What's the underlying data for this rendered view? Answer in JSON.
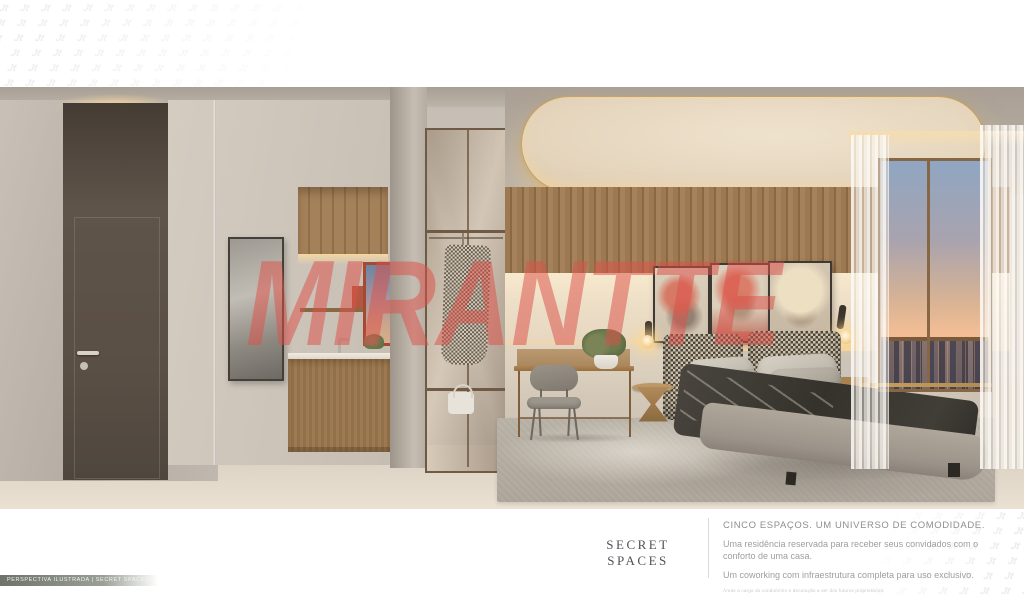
{
  "watermark": {
    "text": "MIRANTTE",
    "color": "#dd5048"
  },
  "corner_pattern": {
    "glyph": "Jt"
  },
  "caption_bar": {
    "text": "PERSPECTIVA ILUSTRADA | SECRET SPACES"
  },
  "footer": {
    "title": "SECRET SPACES",
    "headline": "CINCO ESPAÇOS. UM UNIVERSO DE COMODIDADE.",
    "paragraph1": "Uma residência reservada para receber seus convidados com o conforto de uma casa.",
    "paragraph2": "Um coworking com infraestrutura completa para uso exclusivo.",
    "fine_print": "Áreas a cargo do condomínio e decoração a ser dos futuros proprietários."
  },
  "scene": {
    "description": "Photorealistic interior render of a studio apartment: concrete plaster walls, dark taupe entry door, wood kitchenette with red-framed window, glass wardrobe column with houndstooth coat, desk with upholstered chair, double bed with houndstooth headboard and charcoal bedding, three portrait artworks, curved backlit ceiling panel with gold trim, floor-to-ceiling window with sunset city skyline and sheer curtains",
    "colors": {
      "watermark_red": "#dd5048",
      "gold_trim": "#c9a25f",
      "wood": "#9a774f",
      "concrete": "#c3bbb1",
      "floor": "#ded4c5",
      "bedding_charcoal": "#3a3835",
      "sky_top": "#8fa6c2",
      "sky_horizon": "#f2bd95"
    }
  }
}
